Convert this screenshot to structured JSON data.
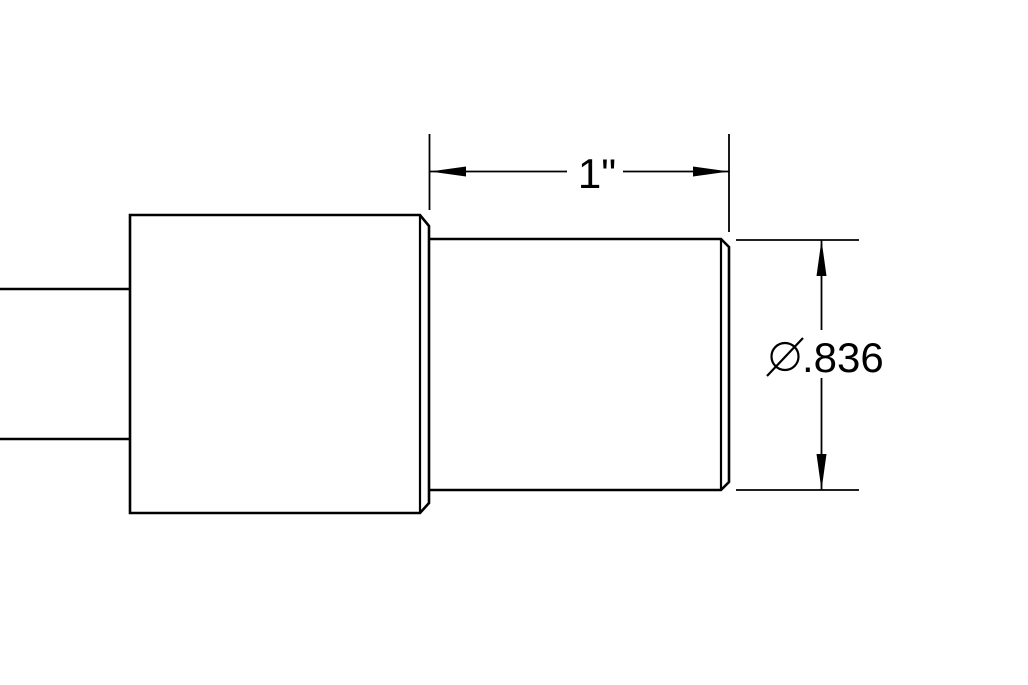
{
  "canvas": {
    "background_color": "#ffffff",
    "line_color": "#000000"
  },
  "dimensions": {
    "width": {
      "label": "1\"",
      "type": "linear-horizontal"
    },
    "diameter": {
      "label": "Ø.836",
      "symbol": "Ø",
      "value": ".836",
      "type": "diameter-vertical"
    }
  }
}
